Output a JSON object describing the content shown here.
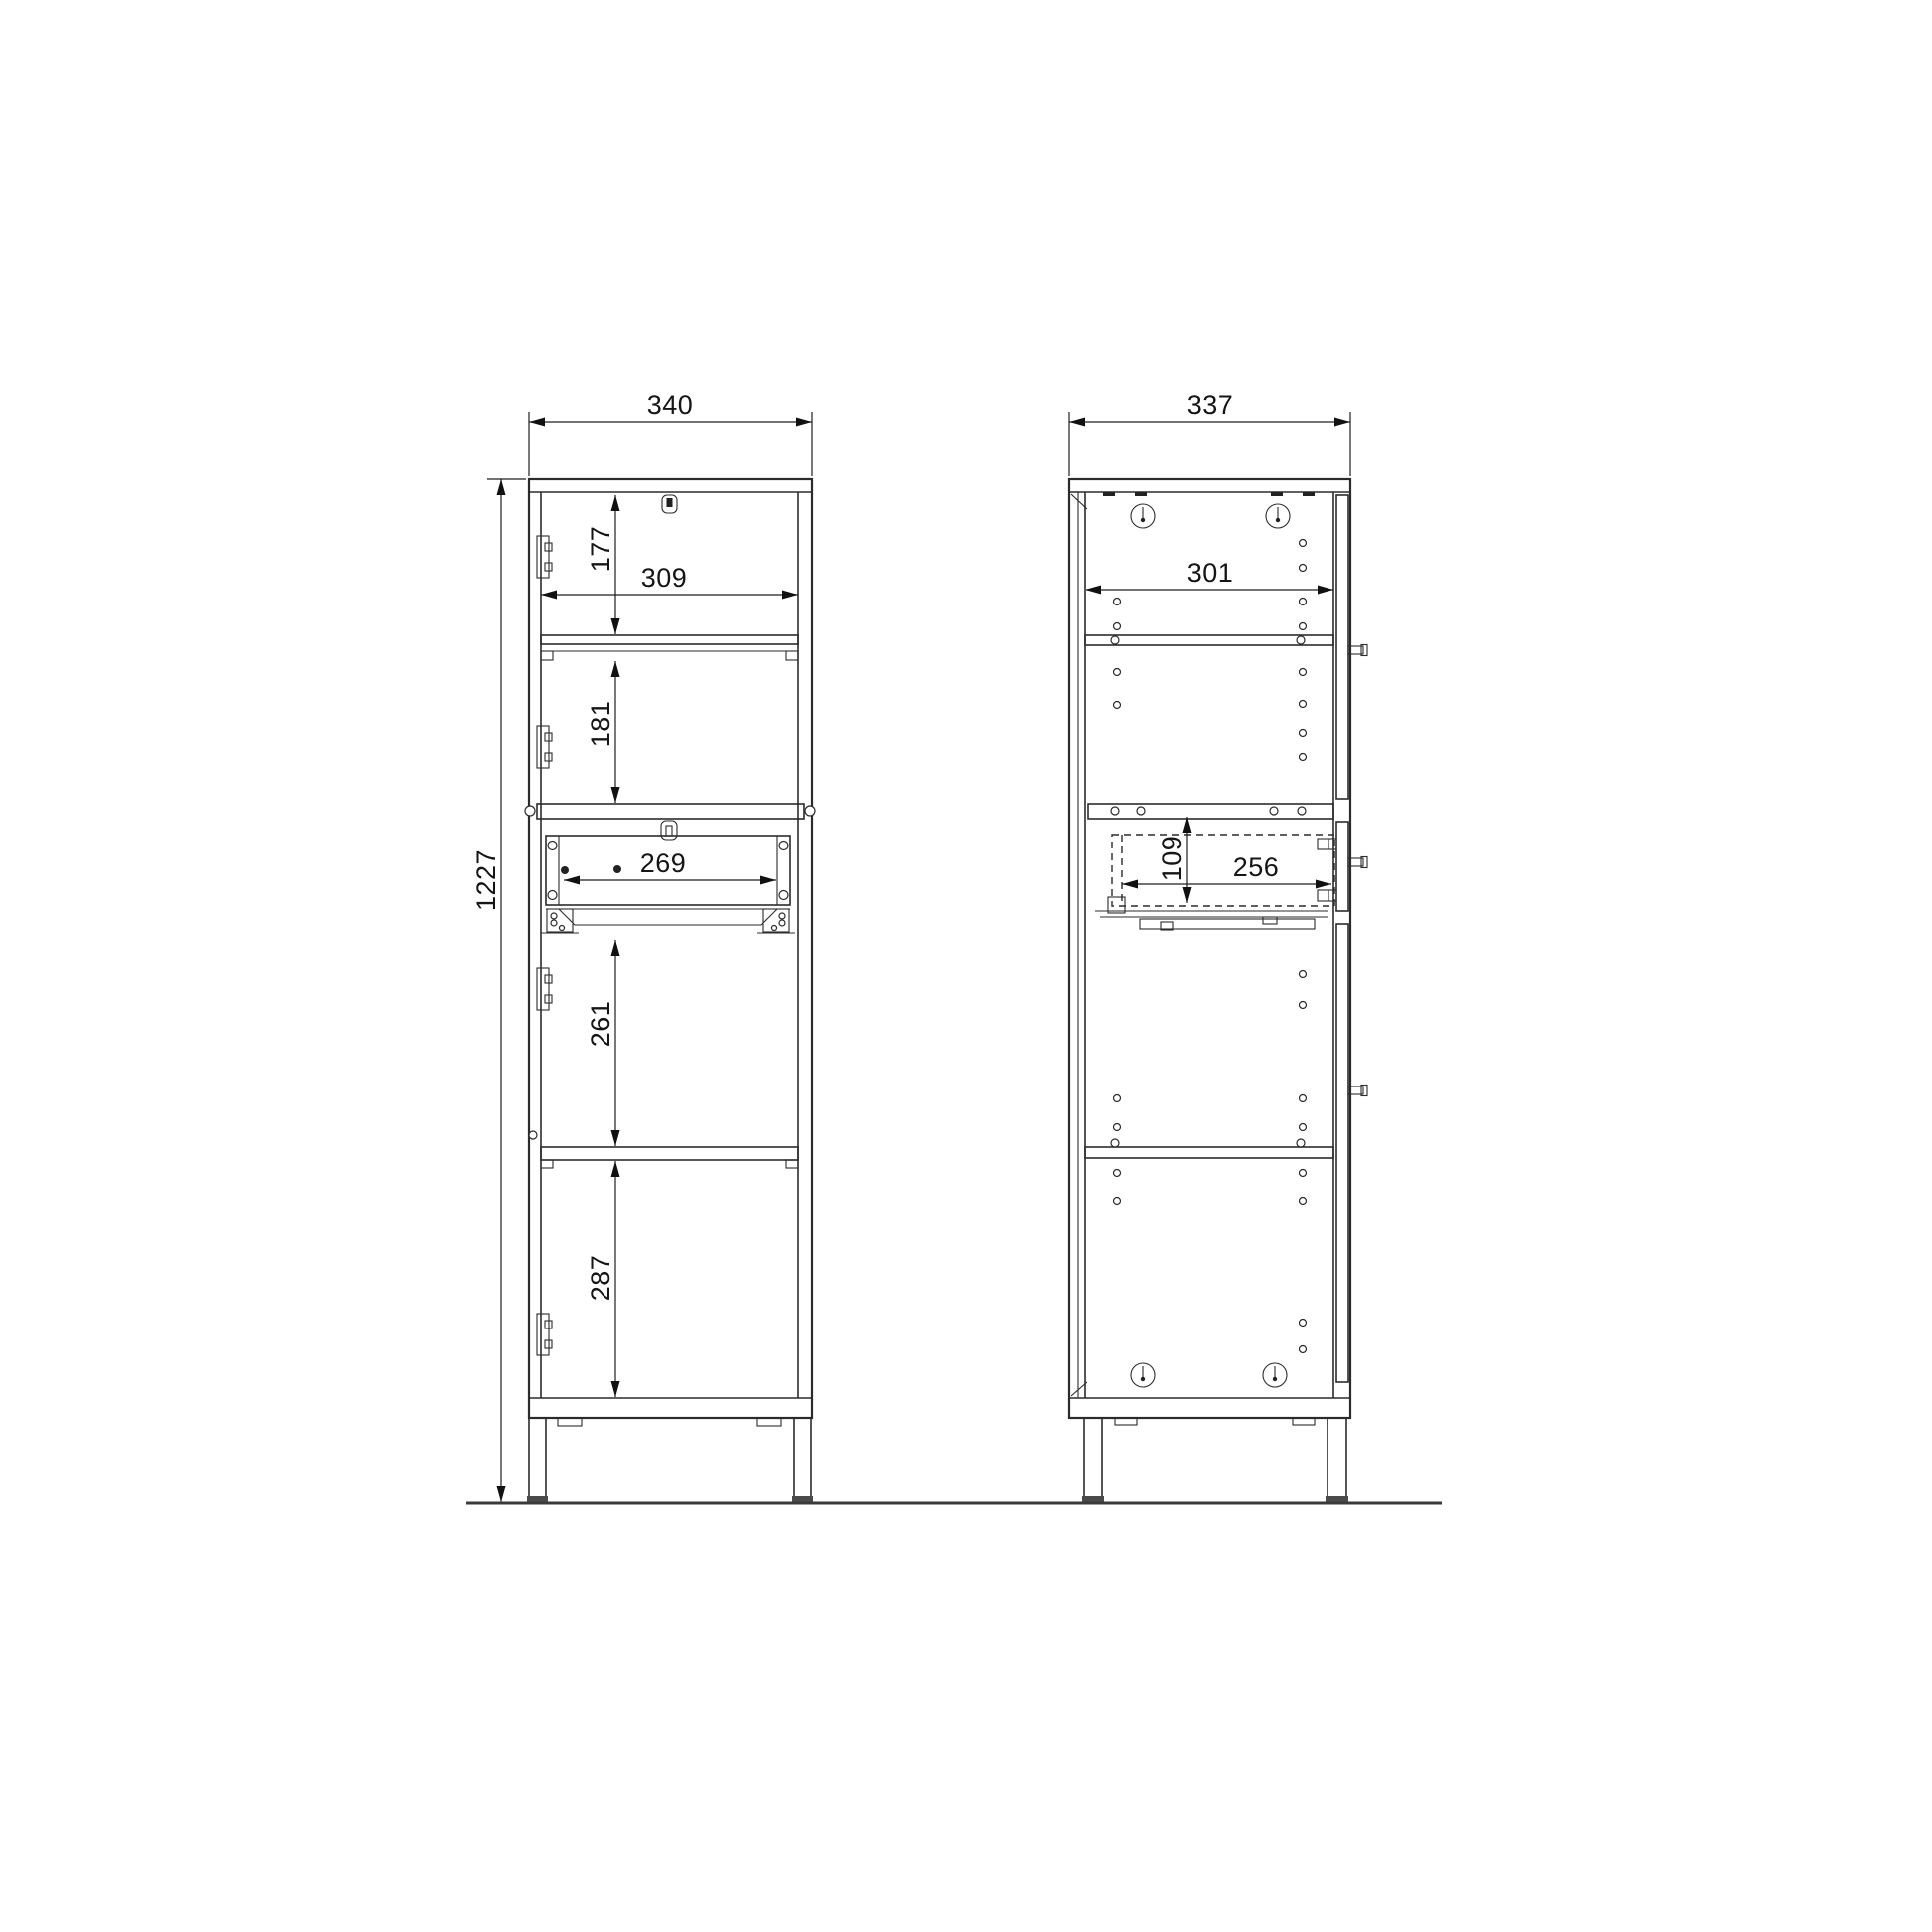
{
  "drawing": {
    "title": "cabinet-dimension-drawing",
    "units": "mm",
    "colors": {
      "line": "#2b2b2b",
      "text": "#151515",
      "background": "#ffffff"
    },
    "views": {
      "front": {
        "label": "front-view",
        "dims": {
          "overall_width": "340",
          "overall_height": "1227",
          "interior_width": "309",
          "top_section_height": "177",
          "second_section_height": "181",
          "drawer_opening_width": "269",
          "third_section_height": "261",
          "bottom_section_height": "287"
        }
      },
      "side": {
        "label": "side-view",
        "dims": {
          "overall_depth": "337",
          "interior_depth": "301",
          "drawer_box_height": "109",
          "drawer_box_depth": "256"
        }
      }
    }
  }
}
